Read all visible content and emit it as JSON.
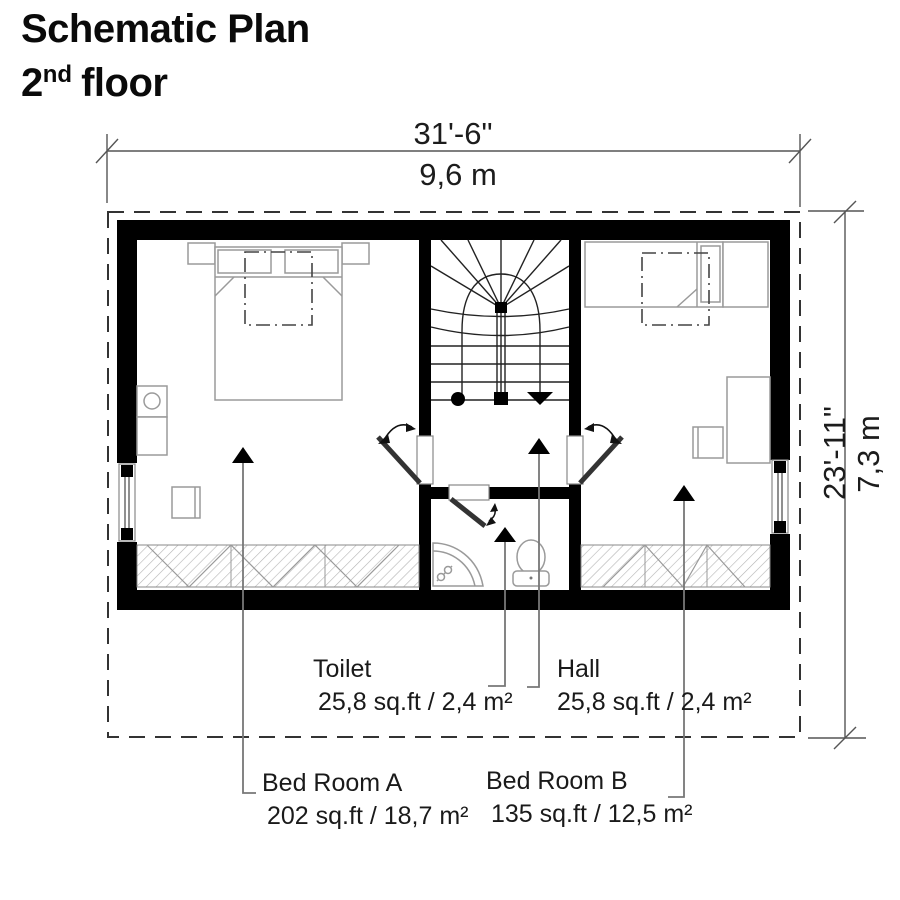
{
  "title": {
    "line1": "Schematic Plan",
    "floor_number": "2",
    "floor_ordinal_suffix": "nd",
    "floor_word": "floor"
  },
  "dimensions": {
    "width": {
      "imperial": "31'-6\"",
      "metric": "9,6 m"
    },
    "depth": {
      "imperial": "23'-11\"",
      "metric": "7,3 m"
    }
  },
  "rooms": {
    "toilet": {
      "name": "Toilet",
      "area": "25,8 sq.ft / 2,4 m²"
    },
    "hall": {
      "name": "Hall",
      "area": "25,8 sq.ft / 2,4 m²"
    },
    "bedroom_a": {
      "name": "Bed Room A",
      "area": "202 sq.ft / 18,7 m²"
    },
    "bedroom_b": {
      "name": "Bed Room B",
      "area": "135 sq.ft / 12,5 m²"
    }
  },
  "colors": {
    "background": "#ffffff",
    "walls": "#000000",
    "furniture_outline": "#9a9a9a",
    "dimension_lines": "#555555",
    "leader_lines": "#777777"
  }
}
